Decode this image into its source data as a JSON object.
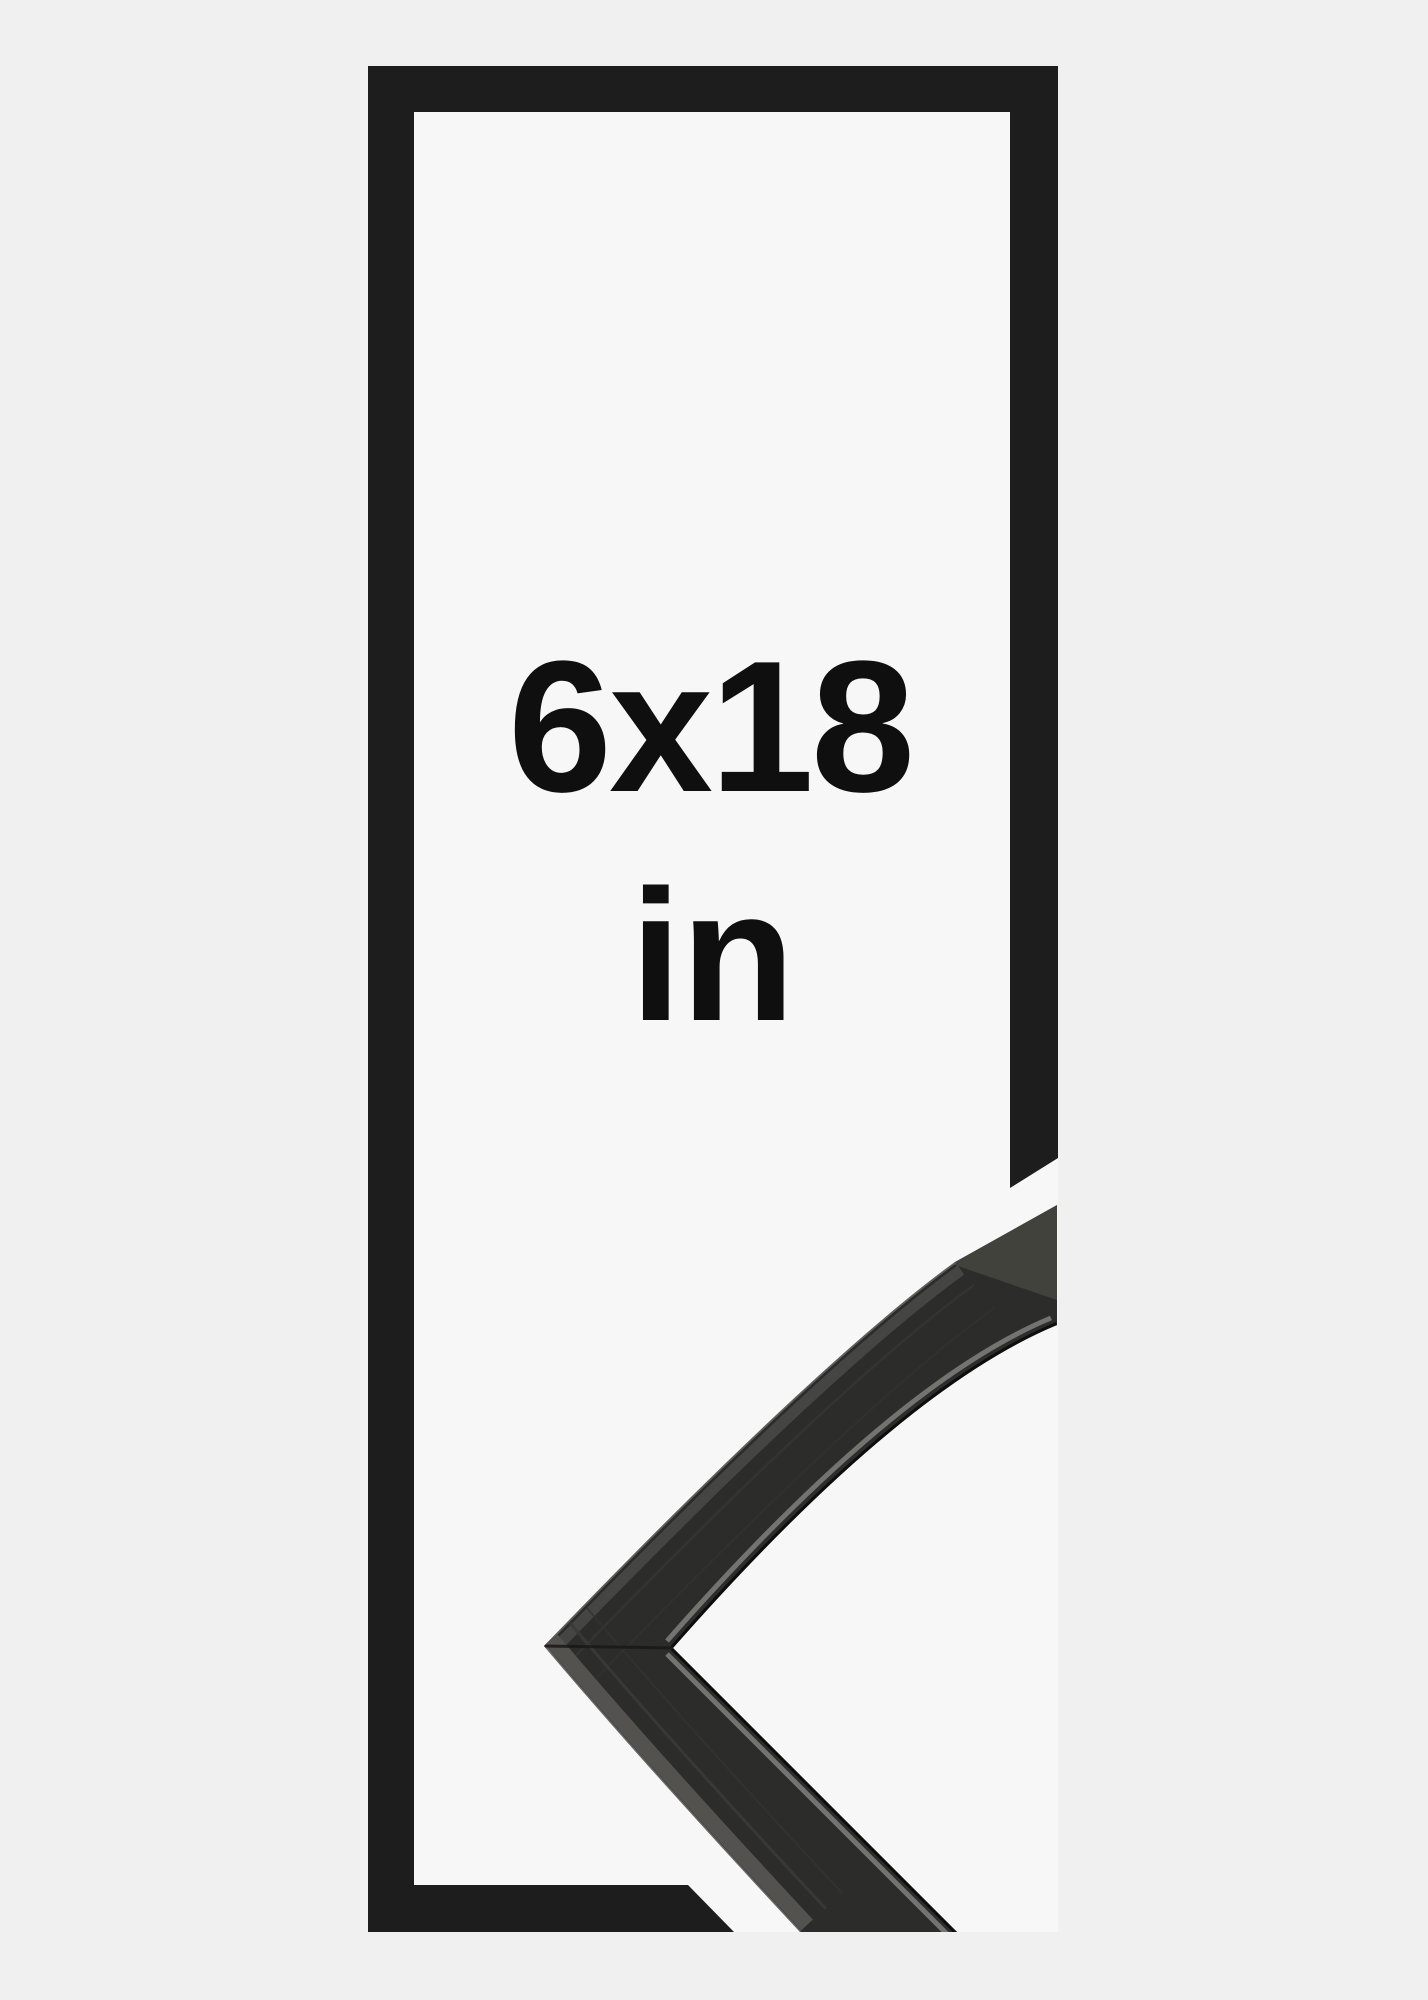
{
  "image": {
    "kind": "frame-size-product-mockup",
    "size_label": "6x18",
    "unit_label": "in"
  },
  "theme": {
    "page_bg": "#f0f0f1",
    "photo_white": "#f7f7f8",
    "frame_black": "#1d1d1d",
    "molding_face": "#2c2c2a",
    "molding_side": "#54524f",
    "molding_sheen": "#73736f",
    "molding_lip": "#0e0e0e",
    "label_color": "#0f0f0f"
  }
}
